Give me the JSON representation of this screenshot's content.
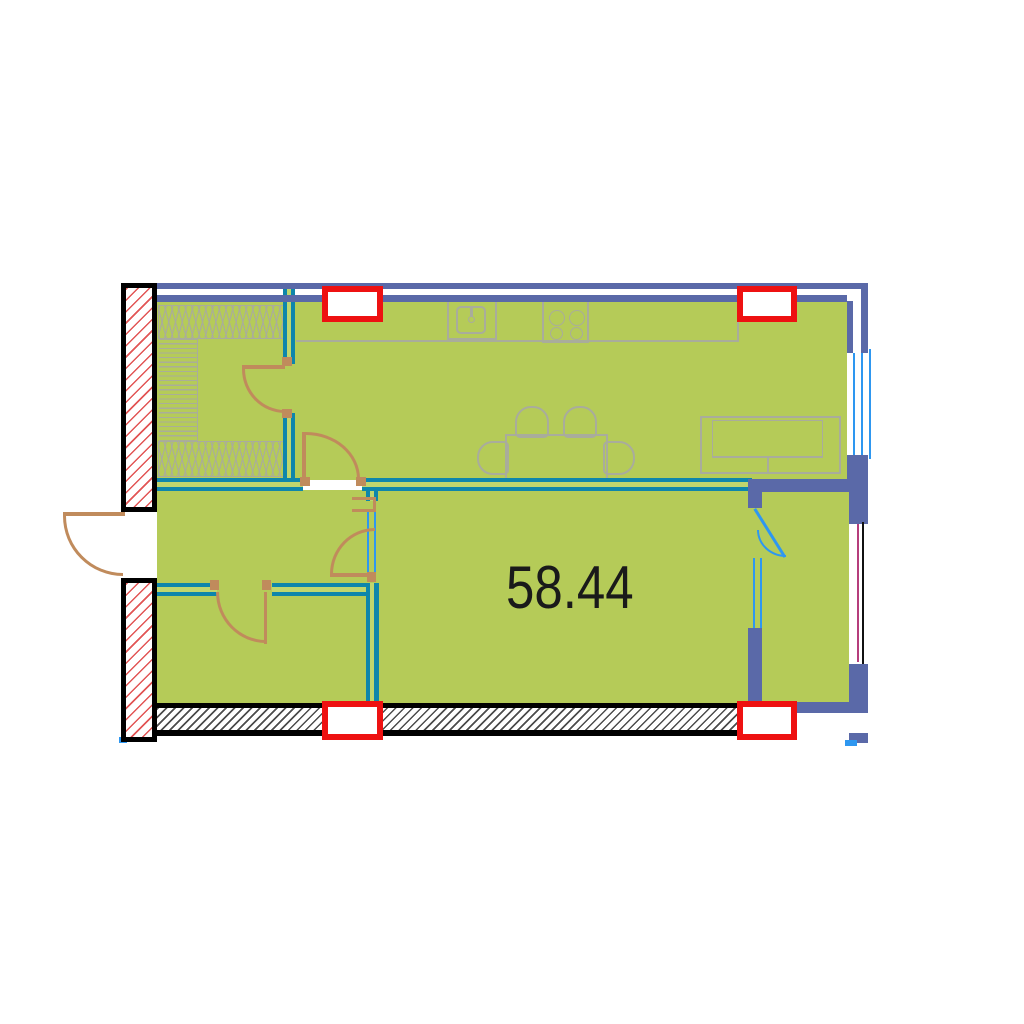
{
  "area_label": {
    "value": "58.44"
  },
  "plan": {
    "type": "apartment-floor-plan",
    "columns_count": 4,
    "doors_count": 6,
    "windows_count": 2,
    "icons": [
      "sink-icon",
      "stove-icon",
      "dining-table-icon",
      "chair-icon",
      "sofa-icon",
      "wardrobe-hatch-icon",
      "door-swing-icon",
      "column-icon",
      "window-icon"
    ]
  },
  "colors": {
    "floor_green": "#b5cb58",
    "wall_slate": "#5a69a8",
    "wall_teal": "#0e86ab",
    "wall_teal_light": "#bfd66e",
    "door_brown": "#c08b5c",
    "column_red": "#ee1111",
    "hatch_red": "#e25555",
    "furniture_gray": "#a9ac9c",
    "window_blue": "#2e97f0",
    "glazing_magenta": "#b53d7c",
    "window_black": "#111111",
    "label_color": "#1a1a1a"
  }
}
